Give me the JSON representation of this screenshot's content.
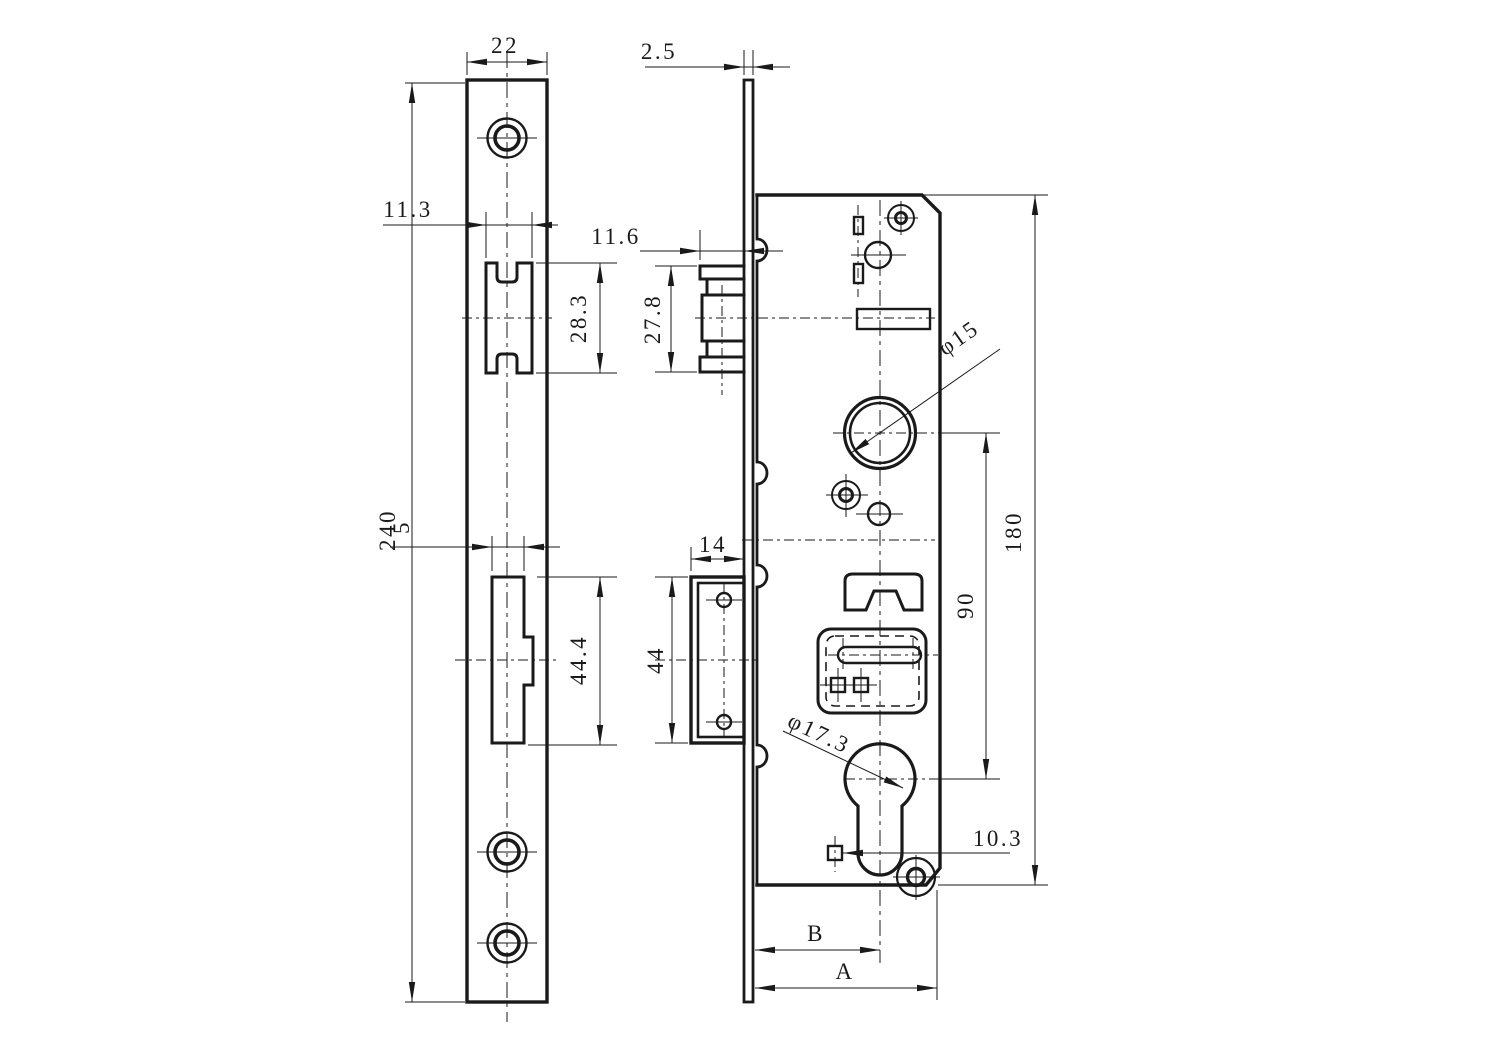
{
  "drawing": {
    "ink_color": "#1a1a1a",
    "labels": {
      "front_plate_width": "22",
      "plate_thickness": "2.5",
      "latch_cutout_width": "11.3",
      "latch_projection": "11.6",
      "latch_cutout_height": "28.3",
      "latch_height_side": "27.8",
      "plate_length": "240",
      "bolt_cutout_width": "5",
      "bolt_width_side": "14",
      "bolt_cutout_height": "44.4",
      "bolt_height_side": "44",
      "follower_diameter": "φ15",
      "centers_distance": "90",
      "case_height": "180",
      "cylinder_diameter": "φ17.3",
      "cylinder_screw_offset": "10.3",
      "backset_dim_b": "B",
      "backset_dim_a": "A"
    }
  }
}
